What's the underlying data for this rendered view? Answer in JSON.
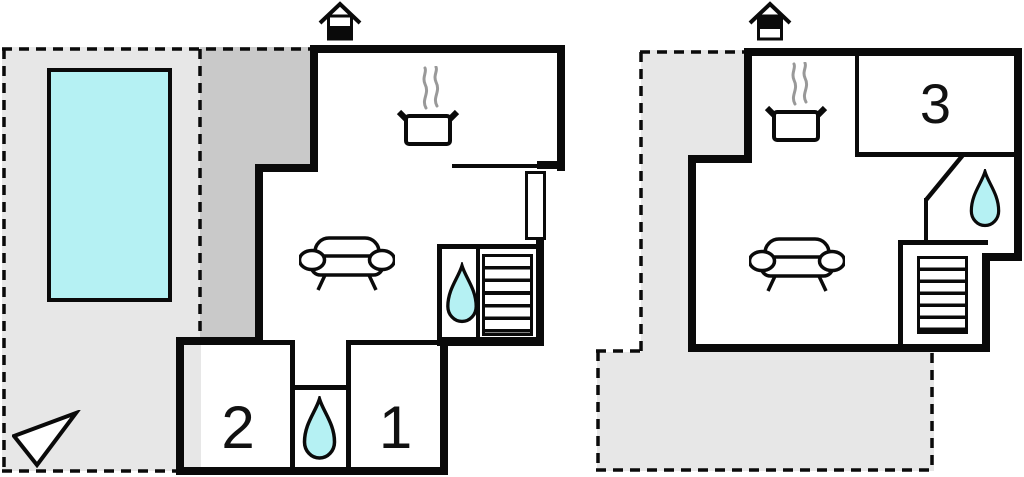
{
  "page": {
    "type": "floor-plan",
    "floors": 2,
    "plan_left": "ground-floor-with-pool-terrace",
    "plan_right": "upper-floor-with-terrace"
  },
  "rooms": {
    "room1": {
      "label": "1"
    },
    "room2": {
      "label": "2"
    },
    "room3": {
      "label": "3"
    }
  },
  "features": {
    "left_plan": [
      "pool",
      "terrace",
      "kitchen-stove",
      "sofa",
      "stairs",
      "bathroom-water-drop",
      "hall-bathroom-water-drop",
      "north-arrow",
      "ground-floor-indicator-house"
    ],
    "right_plan": [
      "terrace",
      "kitchen-stove",
      "sofa",
      "stairs",
      "bathroom-water-drop",
      "upper-floor-indicator-house"
    ]
  },
  "colors": {
    "wall": "#0a0a0a",
    "terrace_light": "#e7e7e7",
    "terrace_dark": "#c9c9c9",
    "water": "#b5f1f3",
    "steam": "#999999"
  }
}
